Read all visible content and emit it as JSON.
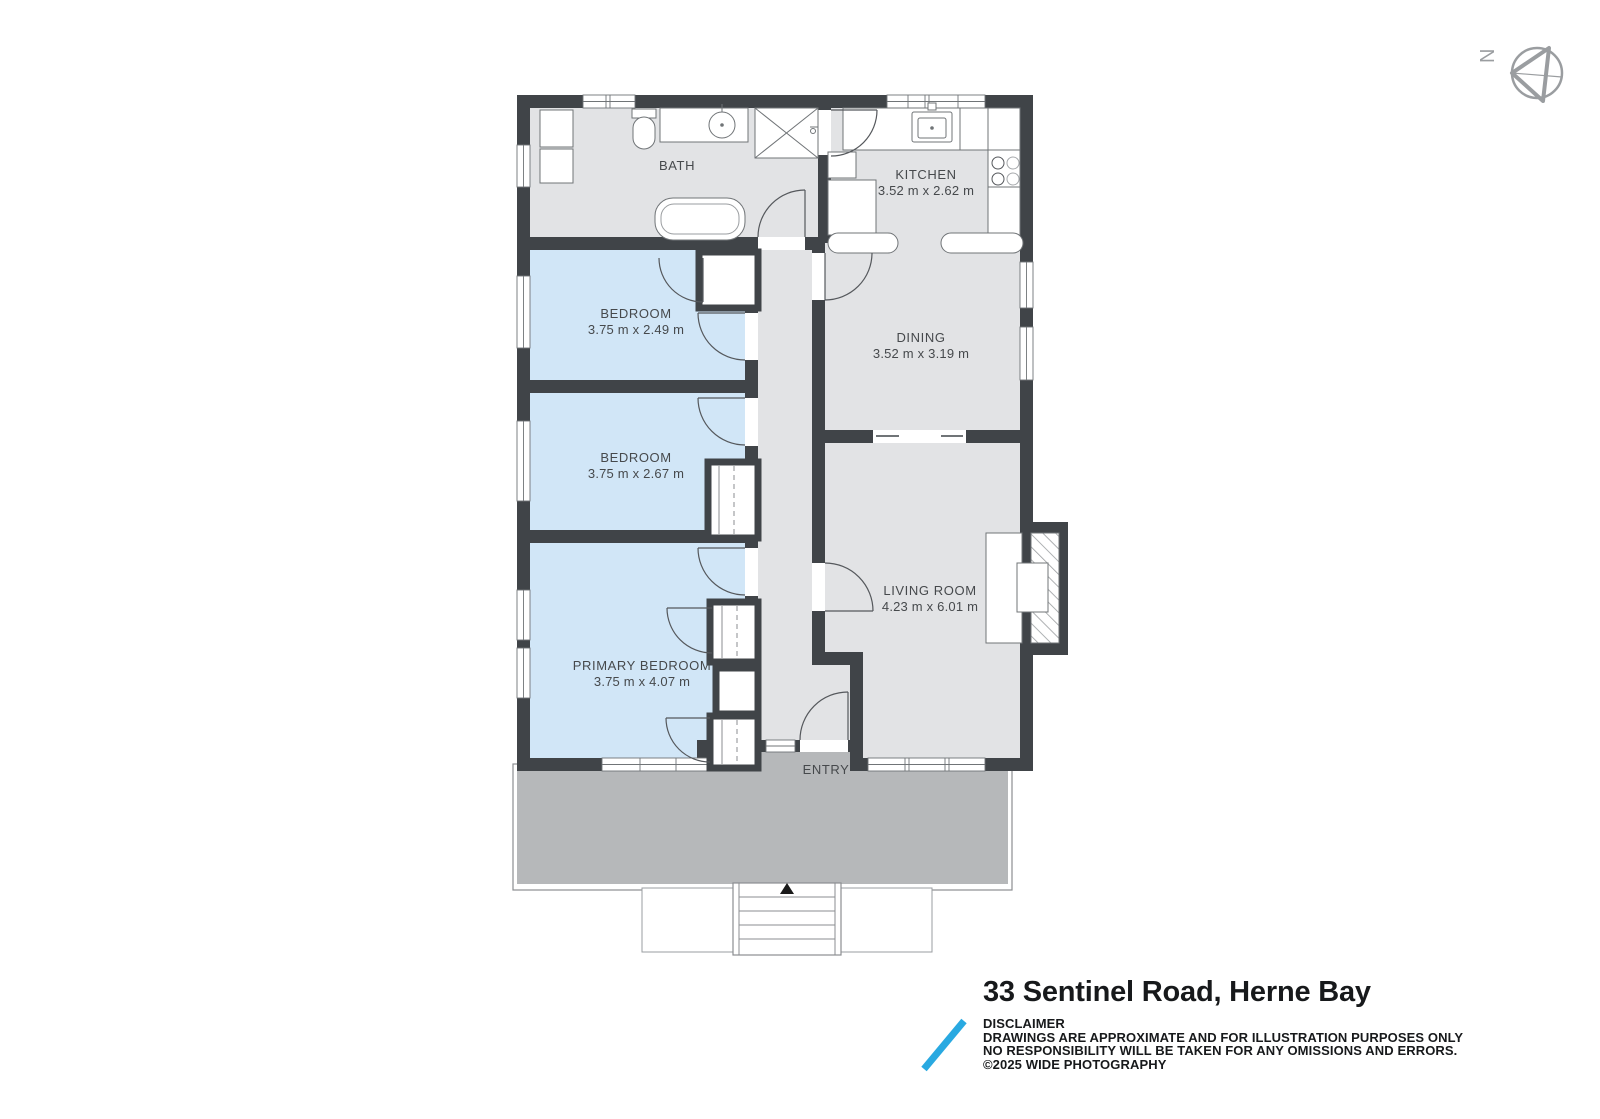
{
  "compass": {
    "label": "N"
  },
  "rooms": {
    "bath": {
      "name": "BATH"
    },
    "kitchen": {
      "name": "KITCHEN",
      "dims": "3.52 m x 2.62 m"
    },
    "bedroom1": {
      "name": "BEDROOM",
      "dims": "3.75 m x 2.49 m"
    },
    "dining": {
      "name": "DINING",
      "dims": "3.52 m x 3.19 m"
    },
    "bedroom2": {
      "name": "BEDROOM",
      "dims": "3.75 m x 2.67 m"
    },
    "living": {
      "name": "LIVING ROOM",
      "dims": "4.23 m x 6.01 m"
    },
    "primary": {
      "name": "PRIMARY BEDROOM",
      "dims": "3.75 m x 4.07 m"
    },
    "entry": {
      "name": "ENTRY"
    }
  },
  "footer": {
    "title": "33 Sentinel Road, Herne Bay",
    "disclaimer_heading": "DISCLAIMER",
    "disclaimer_line1": "DRAWINGS ARE APPROXIMATE AND FOR ILLUSTRATION PURPOSES ONLY",
    "disclaimer_line2": "NO RESPONSIBILITY WILL BE TAKEN FOR ANY OMISSIONS AND ERRORS.",
    "copyright": "©2025 WIDE PHOTOGRAPHY"
  },
  "colors": {
    "wall": "#404448",
    "floor_gray": "#e2e3e5",
    "floor_blue": "#d1e6f7",
    "deck_gray": "#b6b8ba",
    "accent_blue": "#29a9e1",
    "label_text": "#46494c"
  }
}
